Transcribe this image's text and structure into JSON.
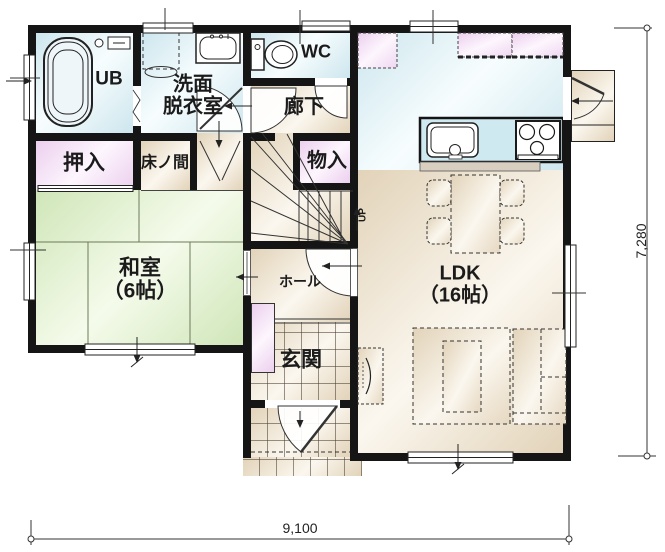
{
  "plan": {
    "title": "1F floor plan",
    "rooms": {
      "ub": "UB",
      "washroom": "洗面\n脱衣室",
      "wc": "WC",
      "corridor": "廊下",
      "closet": "押入",
      "tokonoma": "床ノ間",
      "storage": "物入",
      "washitsu": "和室\n（6帖）",
      "hall": "ホール",
      "entrance": "玄関",
      "ldk": "LDK\n（16帖）",
      "stairs_up": "UP"
    },
    "dimensions": {
      "width": "9,100",
      "height": "7,280"
    },
    "colors": {
      "wall": "#151515",
      "water-a": "#cde6ee",
      "water-b": "#f7fdfe",
      "pink-a": "#eccfee",
      "pink-b": "#fdf6fe",
      "tatami-a": "#cfe6b8",
      "tatami-b": "#f5fbeb",
      "floor-a": "#e2d3b9",
      "floor-b": "#fbf7ef",
      "counter": "#cfe9f0",
      "line": "#333333"
    }
  }
}
